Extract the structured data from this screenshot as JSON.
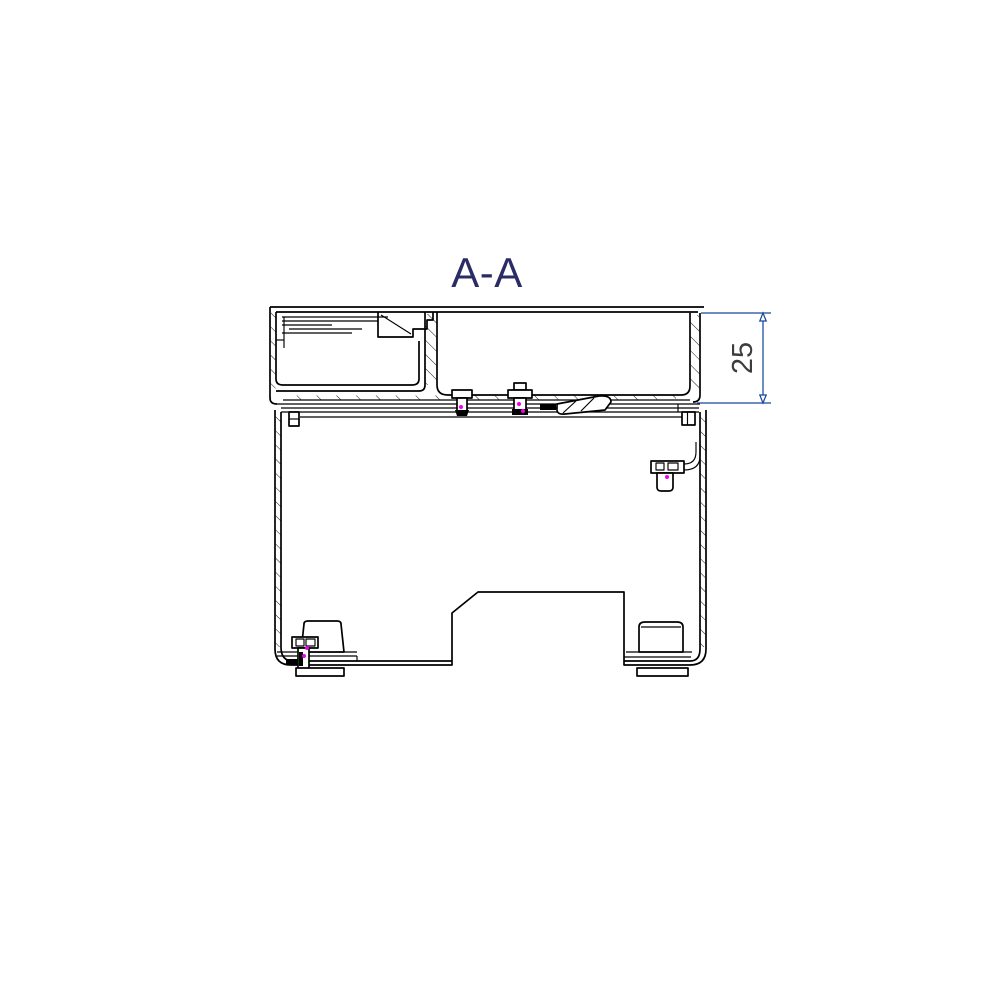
{
  "drawing": {
    "title": "A-A",
    "dimension_value": "25"
  },
  "colors": {
    "background": "#ffffff",
    "line": "#000000",
    "title_text": "#2b2c64",
    "dimension_line": "#17479e",
    "dimension_text": "#3c3c3c",
    "highlight_magenta": "#ee00ee"
  }
}
